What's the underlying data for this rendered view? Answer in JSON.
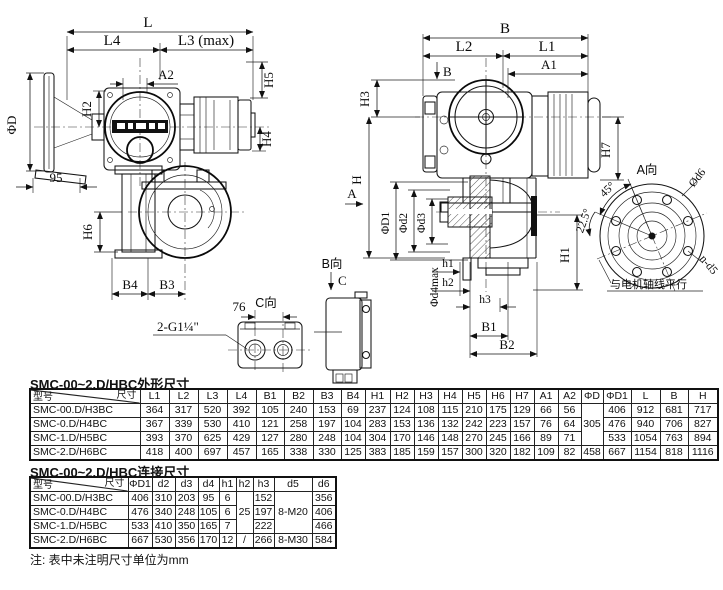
{
  "colors": {
    "line": "#1a1a1a",
    "background": "#ffffff",
    "label_band": "#111111"
  },
  "drawing": {
    "left_view_dims": {
      "L": "L",
      "L4": "L4",
      "L3max": "L3 (max)",
      "A2": "A2",
      "H2": "H2",
      "PhiD": "ΦD",
      "H5": "H5",
      "H4": "H4",
      "n95": "95",
      "H6": "H6",
      "B4": "B4",
      "B3": "B3",
      "conduit": "2-G1¼\""
    },
    "right_view_dims": {
      "B": "B",
      "L2": "L2",
      "L1": "L1",
      "A1": "A1",
      "Bview": "B",
      "H3": "H3",
      "H": "H",
      "Aview": "A",
      "PhiD1": "ΦD1",
      "Phid2": "Φd2",
      "Phid3": "Φd3",
      "H7": "H7",
      "H1": "H1",
      "h1": "h1",
      "h2": "h2",
      "h3": "h3",
      "Phid4max": "Φd4max",
      "B1": "B1",
      "B2": "B2"
    },
    "a_view": {
      "title": "A向",
      "d6": "Ød6",
      "deg45": "45°",
      "deg225": "22.5°",
      "nd5": "n-d5",
      "note": "与电机轴线平行"
    },
    "b_view": {
      "title": "B向",
      "c": "C"
    },
    "c_view": {
      "title": "C向",
      "d76": "76"
    }
  },
  "table1": {
    "title": "SMC-00~2.D/HBC外形尺寸",
    "corner_top": "尺寸",
    "corner_bottom": "型号",
    "columns": [
      "L1",
      "L2",
      "L3",
      "L4",
      "B1",
      "B2",
      "B3",
      "B4",
      "H1",
      "H2",
      "H3",
      "H4",
      "H5",
      "H6",
      "H7",
      "A1",
      "A2",
      "ΦD",
      "ΦD1",
      "L",
      "B",
      "H"
    ],
    "rows": [
      {
        "model": "SMC-00.D/H3BC",
        "v": [
          "364",
          "317",
          "520",
          "392",
          "105",
          "240",
          "153",
          "69",
          "237",
          "124",
          "108",
          "115",
          "210",
          "175",
          "129",
          "66",
          "56"
        ],
        "phiD": "305",
        "tail": [
          "406",
          "912",
          "681",
          "717"
        ]
      },
      {
        "model": "SMC-0.D/H4BC",
        "v": [
          "367",
          "339",
          "530",
          "410",
          "121",
          "258",
          "197",
          "104",
          "283",
          "153",
          "136",
          "132",
          "242",
          "223",
          "157",
          "76",
          "64"
        ],
        "tail": [
          "476",
          "940",
          "706",
          "827"
        ]
      },
      {
        "model": "SMC-1.D/H5BC",
        "v": [
          "393",
          "370",
          "625",
          "429",
          "127",
          "280",
          "248",
          "104",
          "304",
          "170",
          "146",
          "148",
          "270",
          "245",
          "166",
          "89",
          "71"
        ],
        "tail": [
          "533",
          "1054",
          "763",
          "894"
        ]
      },
      {
        "model": "SMC-2.D/H6BC",
        "v": [
          "418",
          "400",
          "697",
          "457",
          "165",
          "338",
          "330",
          "125",
          "383",
          "185",
          "159",
          "157",
          "300",
          "320",
          "182",
          "109",
          "82"
        ],
        "phiD": "458",
        "tail": [
          "667",
          "1154",
          "818",
          "1116"
        ]
      }
    ]
  },
  "table2": {
    "title": "SMC-00~2.D/HBC连接尺寸",
    "corner_top": "尺寸",
    "corner_bottom": "型号",
    "columns": [
      "ΦD1",
      "d2",
      "d3",
      "d4",
      "h1",
      "h2",
      "h3",
      "d5",
      "d6"
    ],
    "rows": [
      {
        "model": "SMC-00.D/H3BC",
        "v": [
          "406",
          "310",
          "203",
          "95",
          "6"
        ],
        "h2": "25",
        "h3": "152",
        "d5": "8-M20",
        "d6": "356"
      },
      {
        "model": "SMC-0.D/H4BC",
        "v": [
          "476",
          "340",
          "248",
          "105",
          "6"
        ],
        "h3": "197",
        "d6": "406"
      },
      {
        "model": "SMC-1.D/H5BC",
        "v": [
          "533",
          "410",
          "350",
          "165",
          "7"
        ],
        "h3": "222",
        "d6": "466"
      },
      {
        "model": "SMC-2.D/H6BC",
        "v": [
          "667",
          "530",
          "356",
          "170",
          "12"
        ],
        "h2": "/",
        "h3": "266",
        "d5": "8-M30",
        "d6": "584"
      }
    ]
  },
  "note": "注: 表中未注明尺寸单位为mm"
}
